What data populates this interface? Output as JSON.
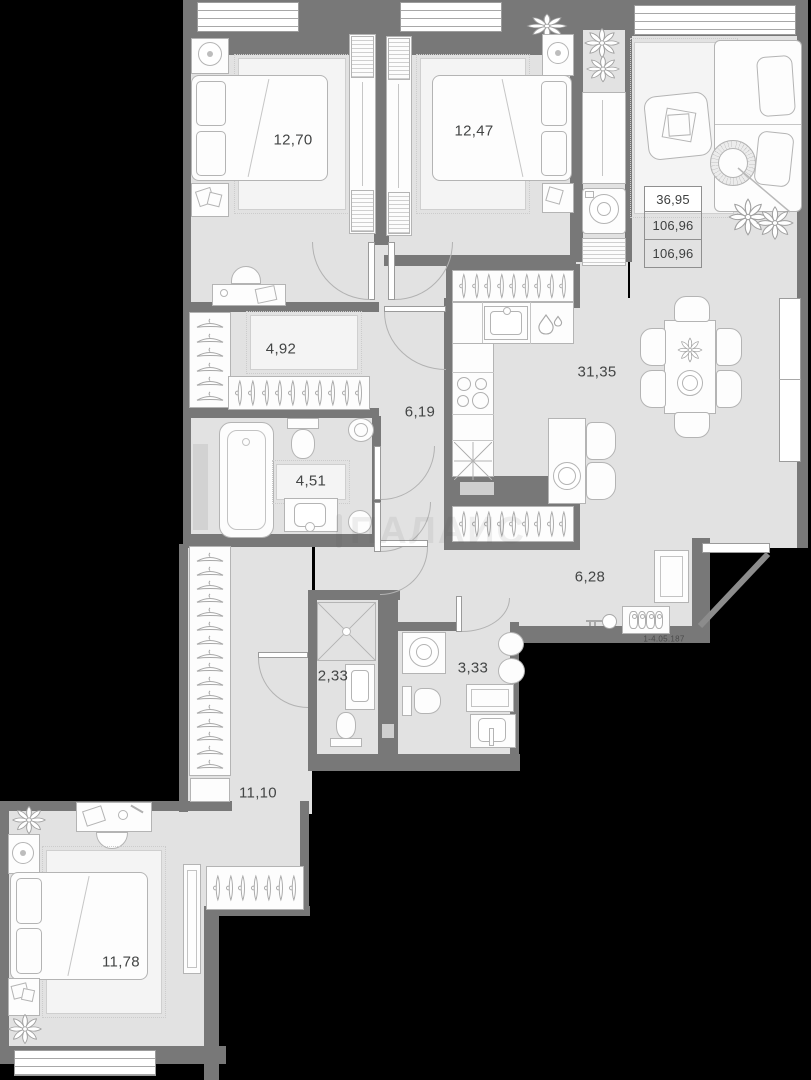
{
  "plan": {
    "unit_number": "1-4.05.187",
    "watermark": "ПАЛАИС",
    "summary": {
      "values": [
        "36,95",
        "106,96",
        "106,96"
      ]
    },
    "rooms": [
      {
        "name": "bedroom-1",
        "area": "12,70"
      },
      {
        "name": "bedroom-2",
        "area": "12,47"
      },
      {
        "name": "kitchen-living",
        "area": "31,35"
      },
      {
        "name": "hallway",
        "area": "6,19"
      },
      {
        "name": "wardrobe",
        "area": "4,92"
      },
      {
        "name": "bathroom",
        "area": "4,51"
      },
      {
        "name": "entrance-hall",
        "area": "6,28"
      },
      {
        "name": "shower-room",
        "area": "2,33"
      },
      {
        "name": "bathroom-2",
        "area": "3,33"
      },
      {
        "name": "corridor",
        "area": "11,10"
      },
      {
        "name": "bedroom-3",
        "area": "11,78"
      }
    ],
    "colors": {
      "background": "#000000",
      "walls": "#787878",
      "floor": "#e2e2e2",
      "furniture": "#fdfdfd",
      "outline": "#b4b4b4",
      "label_text": "#434545",
      "window_line": "#a8a8a8"
    }
  }
}
